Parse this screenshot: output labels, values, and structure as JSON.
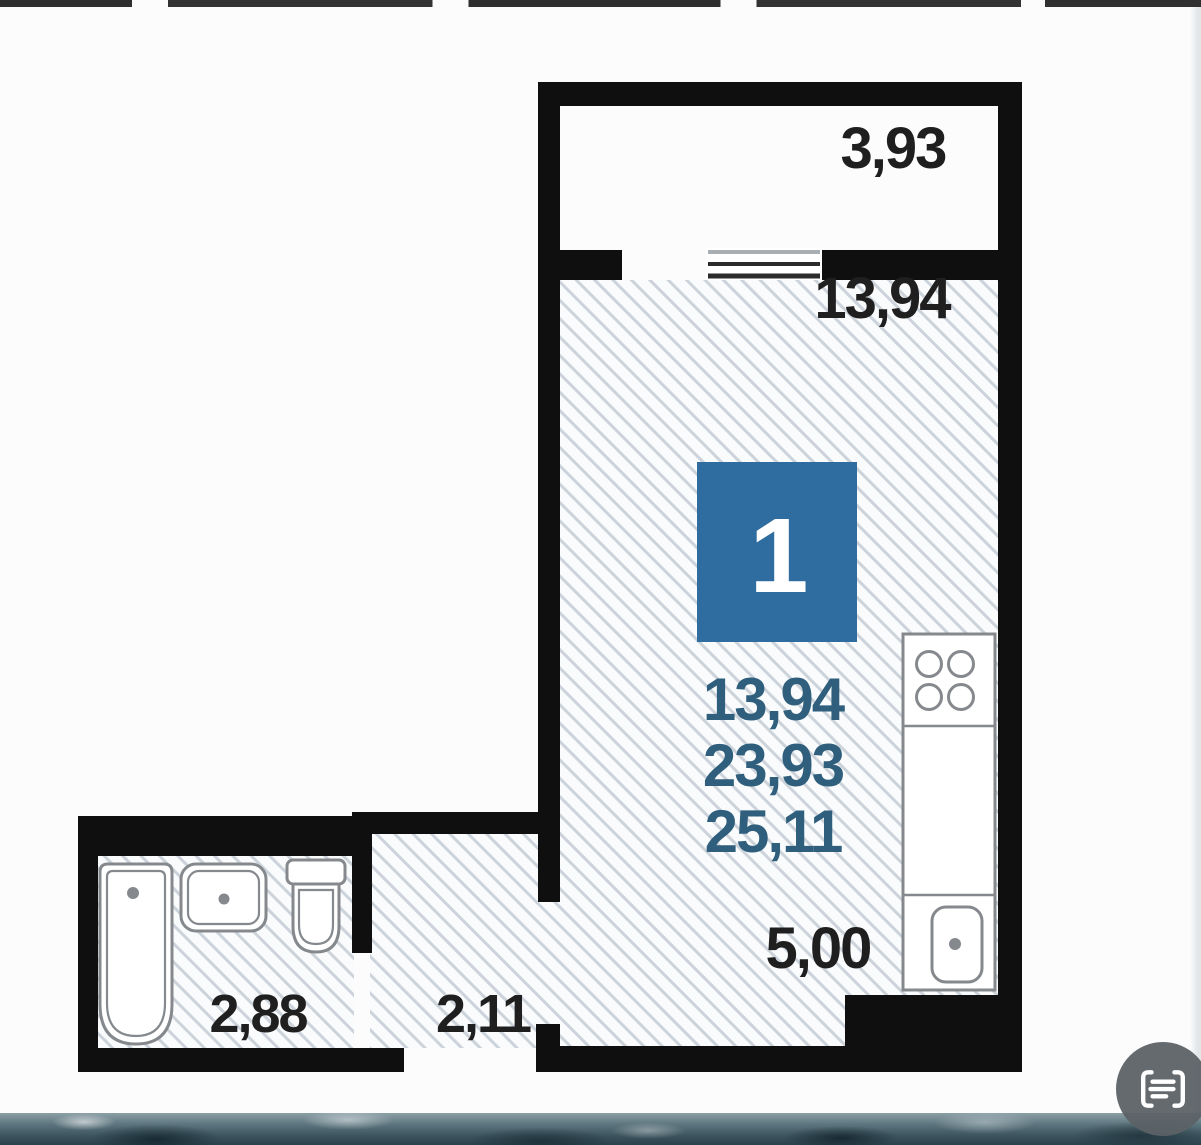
{
  "plan": {
    "badge": {
      "unit_number": "1"
    },
    "balcony": {
      "area": "3,93"
    },
    "room": {
      "area": "13,94"
    },
    "area_stack": {
      "living": "13,94",
      "total": "23,93",
      "total_with_balcony": "25,11"
    },
    "kitchen": {
      "area": "5,00"
    },
    "bathroom": {
      "area": "2,88"
    },
    "hallway": {
      "area": "2,11"
    }
  },
  "icons": {
    "fab": "scan-text-icon"
  },
  "colors": {
    "wall": "#0f0f0f",
    "badge_blue": "#2f6da0",
    "area_text_blue": "#2f5f7c",
    "dimension_text": "#1f1f1f",
    "hatch_line": "#ccd3da",
    "fixture_line": "#85898d",
    "fab_gray": "#5c6266",
    "water_dark": "#31454e"
  }
}
